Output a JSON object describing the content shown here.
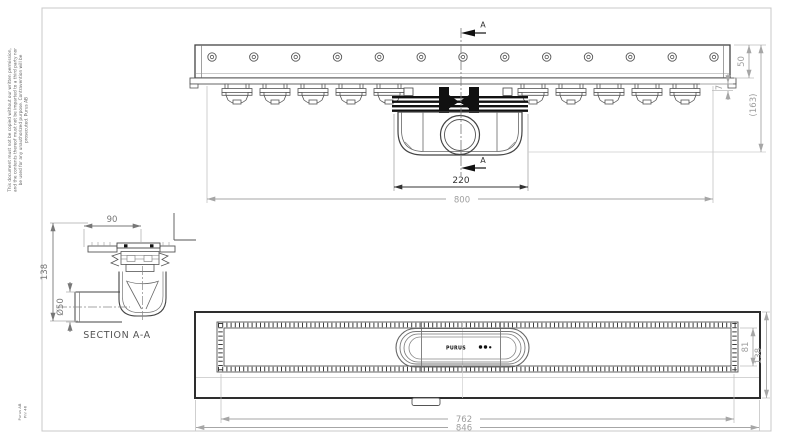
{
  "drawing": {
    "top_view": {
      "dim_trap_length": "220",
      "dim_channel_length": "800",
      "dim_rail_height": "50",
      "dim_flange_offset": "7",
      "dim_overall_height": "(163)",
      "section_marker_top": "A",
      "section_marker_bottom": "A"
    },
    "section_view": {
      "dim_width": "90",
      "dim_height": "138",
      "dim_pipe_diameter": "Ø50",
      "caption": "SECTION A-A"
    },
    "plan_view": {
      "dim_grate_length": "762",
      "dim_overall_length": "846",
      "dim_channel_width": "81",
      "dim_frame_width": "138",
      "brand_label": "PURUS"
    },
    "notes": {
      "copyright_line1": "This document must not be copied without our written permission,",
      "copyright_line2": "and the contents thereof must not be imparted to a third party nor",
      "copyright_line3": "be used for any unauthorized purpose. Contravention will be",
      "copyright_line4": "prosecuted. Purus AB",
      "corner_line1": "Purus AB",
      "corner_line2": "Pnr 46"
    },
    "colors": {
      "line_dark": "#3c3c3c",
      "line_mid": "#6e6e6e",
      "dim_light": "#a6a6a6",
      "black_fill": "#111111",
      "border": "#c8c8c8",
      "background": "#ffffff"
    }
  }
}
